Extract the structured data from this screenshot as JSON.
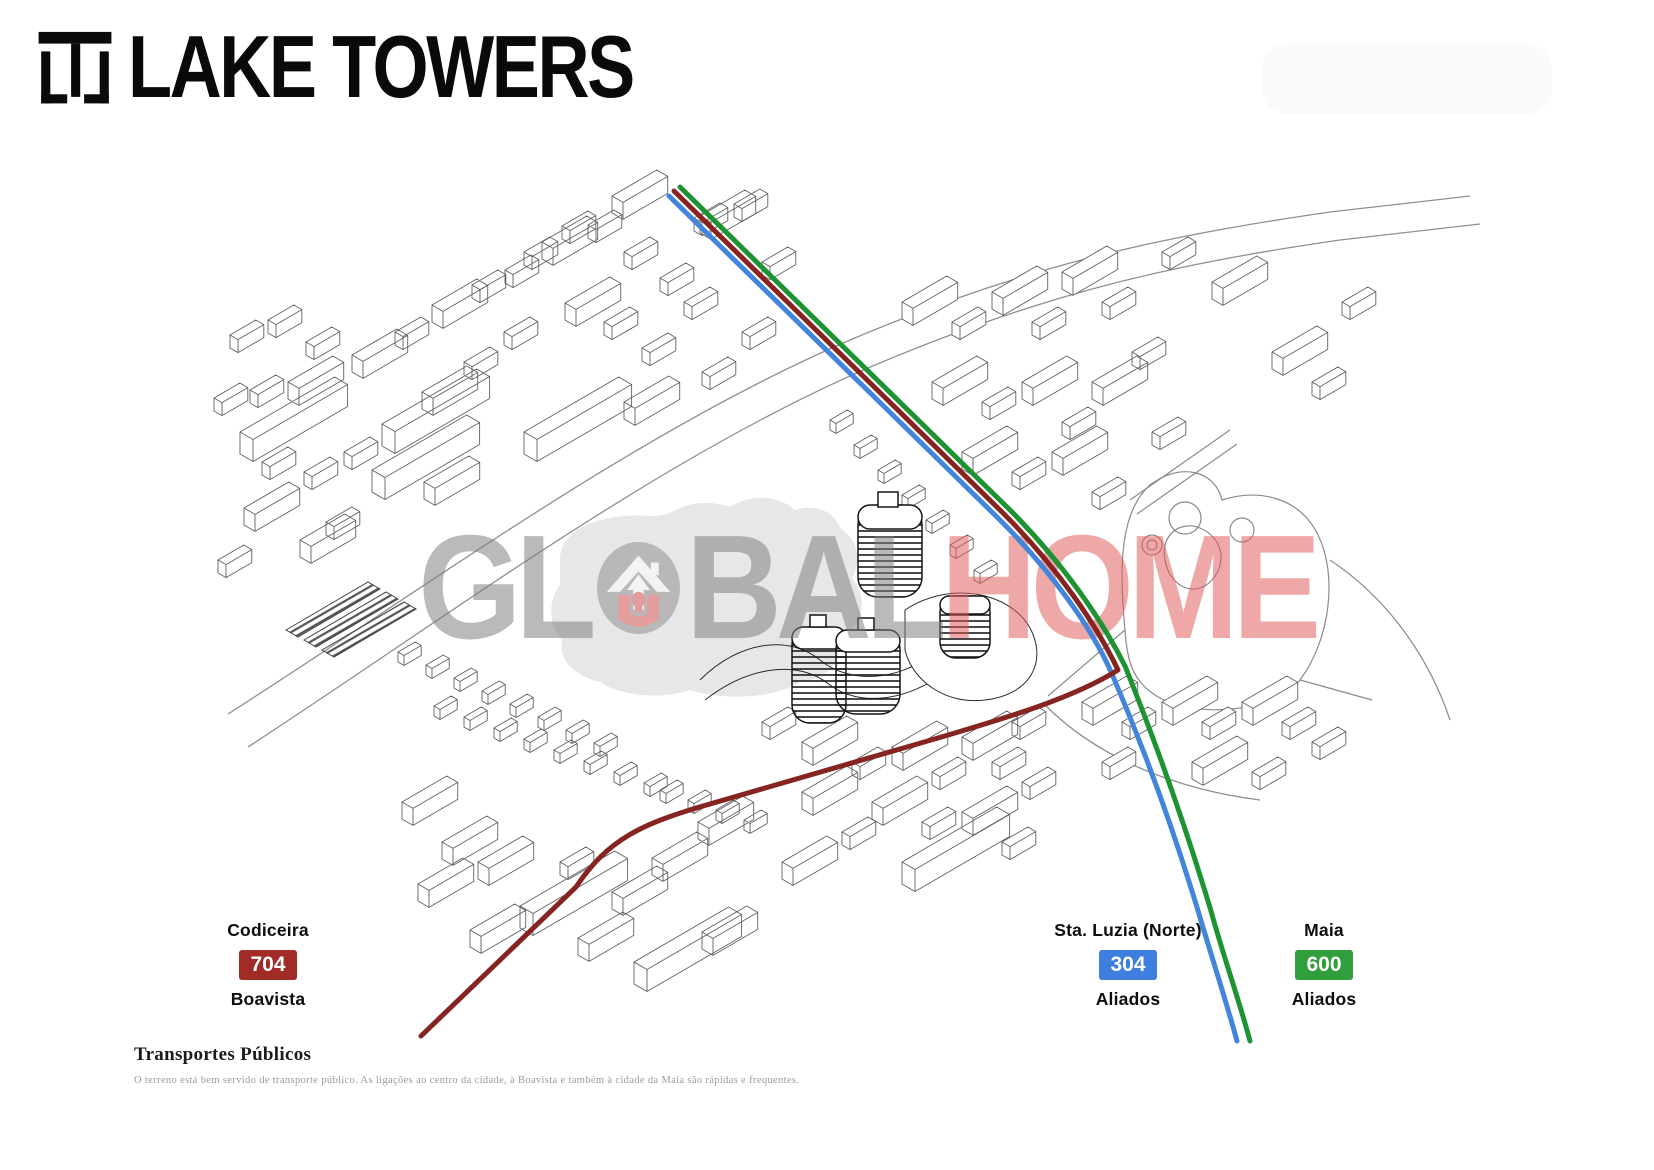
{
  "brand": {
    "name": "LAKE TOWERS"
  },
  "watermark": {
    "left": "GL",
    "mid": "BAL",
    "right": "HOME"
  },
  "transit": {
    "section_title": "Transportes Públicos",
    "description": "O terreno está bem servido de transporte público. As ligações ao centro da cidade, à Boavista e também à cidade da Maia são rápidas e frequentes.",
    "lines": [
      {
        "id": "704",
        "origin": "Codiceira",
        "destination": "Boavista",
        "badge_color": "#a02b27",
        "line_color": "#862422"
      },
      {
        "id": "304",
        "origin": "Sta. Luzia (Norte)",
        "destination": "Aliados",
        "badge_color": "#3e7ede",
        "line_color": "#4285db"
      },
      {
        "id": "600",
        "origin": "Maia",
        "destination": "Aliados",
        "badge_color": "#2f9e3b",
        "line_color": "#1d9333"
      }
    ]
  }
}
